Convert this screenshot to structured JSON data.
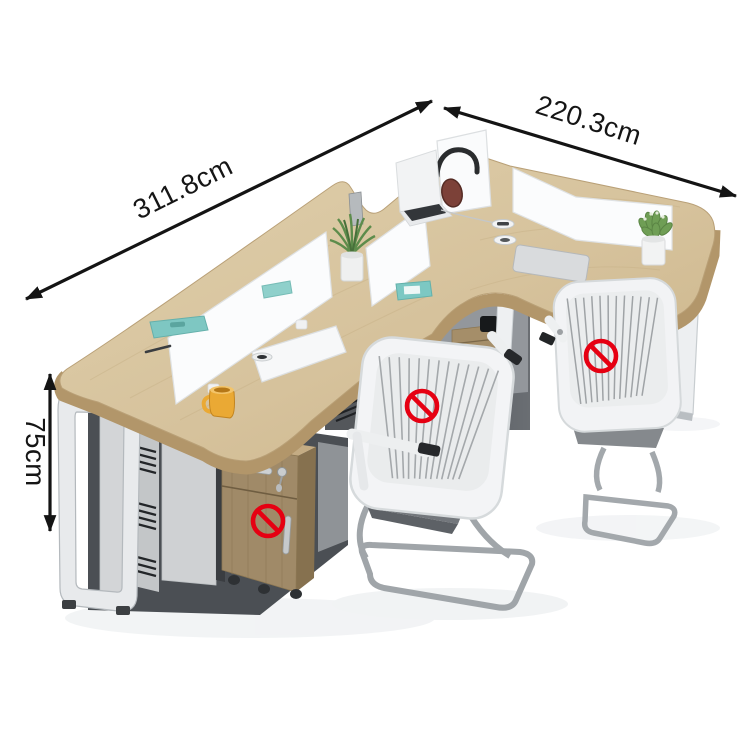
{
  "annotations": {
    "length": {
      "label": "311.8cm"
    },
    "depth": {
      "label": "220.3cm"
    },
    "height": {
      "label": "75cm"
    }
  },
  "prohibition": {
    "symbol": "no-symbol",
    "color": "#e60012",
    "count": 3
  },
  "palette": {
    "background": "#ffffff",
    "arrow": "#141414",
    "desk_wood_top": "#d8c6a2",
    "desk_wood_edge": "#b2966a",
    "pedestal_wood": "#a08a68",
    "partition_white": "#fbfcfd",
    "cabinet_gray": "#d2d4d6",
    "cavity_dark": "#4b4f54",
    "chair_white": "#f3f4f6",
    "chair_seat_gray": "#73777c",
    "chrome": "#a0a5a9",
    "plant_green": "#5d8c4b",
    "mug_yellow": "#eaa934",
    "teal_accessory": "#7ec7c2"
  }
}
